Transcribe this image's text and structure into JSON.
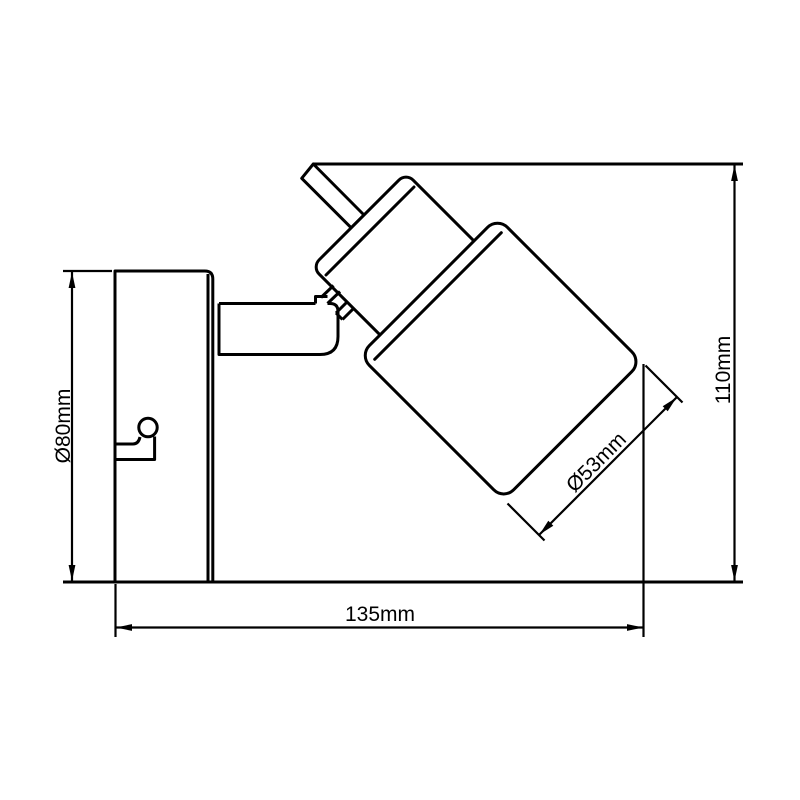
{
  "drawing": {
    "background": "#ffffff",
    "line_color": "#000000",
    "labels": {
      "plate_diameter": "Ø80mm",
      "overall_width": "135mm",
      "overall_height": "110mm",
      "shade_diameter": "Ø53mm"
    }
  }
}
